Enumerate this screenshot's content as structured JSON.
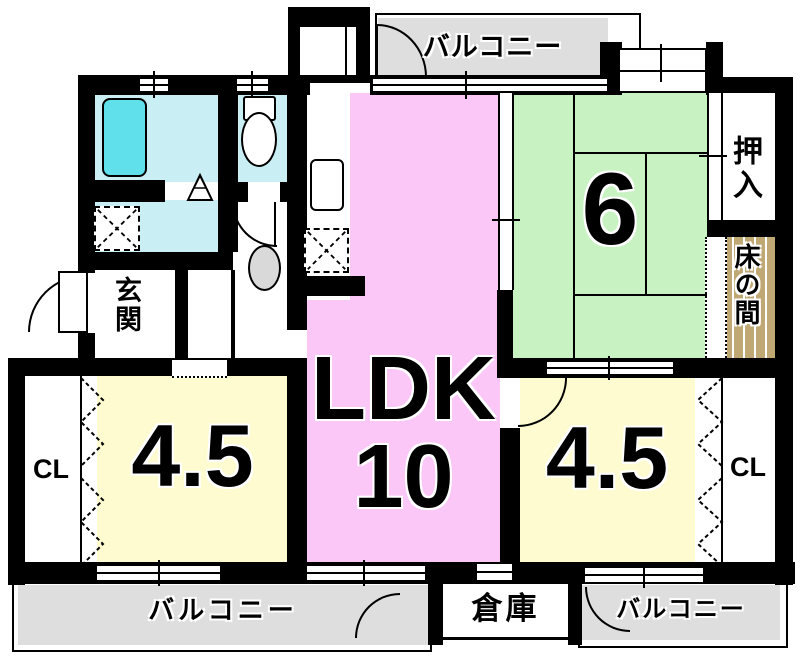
{
  "plan": {
    "title": "apartment floor plan",
    "rooms": {
      "ldk": {
        "line1": "LDK",
        "line2": "10"
      },
      "tatami6": {
        "label": "6"
      },
      "west45": {
        "label": "4.5"
      },
      "east45": {
        "label": "4.5"
      }
    },
    "areas": {
      "balcony_top": "バルコニー",
      "balcony_bottom_left": "バルコニー",
      "balcony_bottom_right": "バルコニー",
      "storage": "倉庫",
      "entrance": "玄関",
      "oshiire": "押入",
      "tokonoma": "床の間",
      "closet_left": "CL",
      "closet_right": "CL"
    },
    "colors": {
      "wall": "#000000",
      "ldk": "#FBC7F7",
      "tatami": "#C9F2C3",
      "western": "#FEFBD0",
      "wet": "#C9EFF5",
      "bathtub": "#5FE0EA",
      "tokonoma": "#BFA873",
      "balcony": "#DEDEDE",
      "fixture": "#D9D9D9"
    }
  }
}
